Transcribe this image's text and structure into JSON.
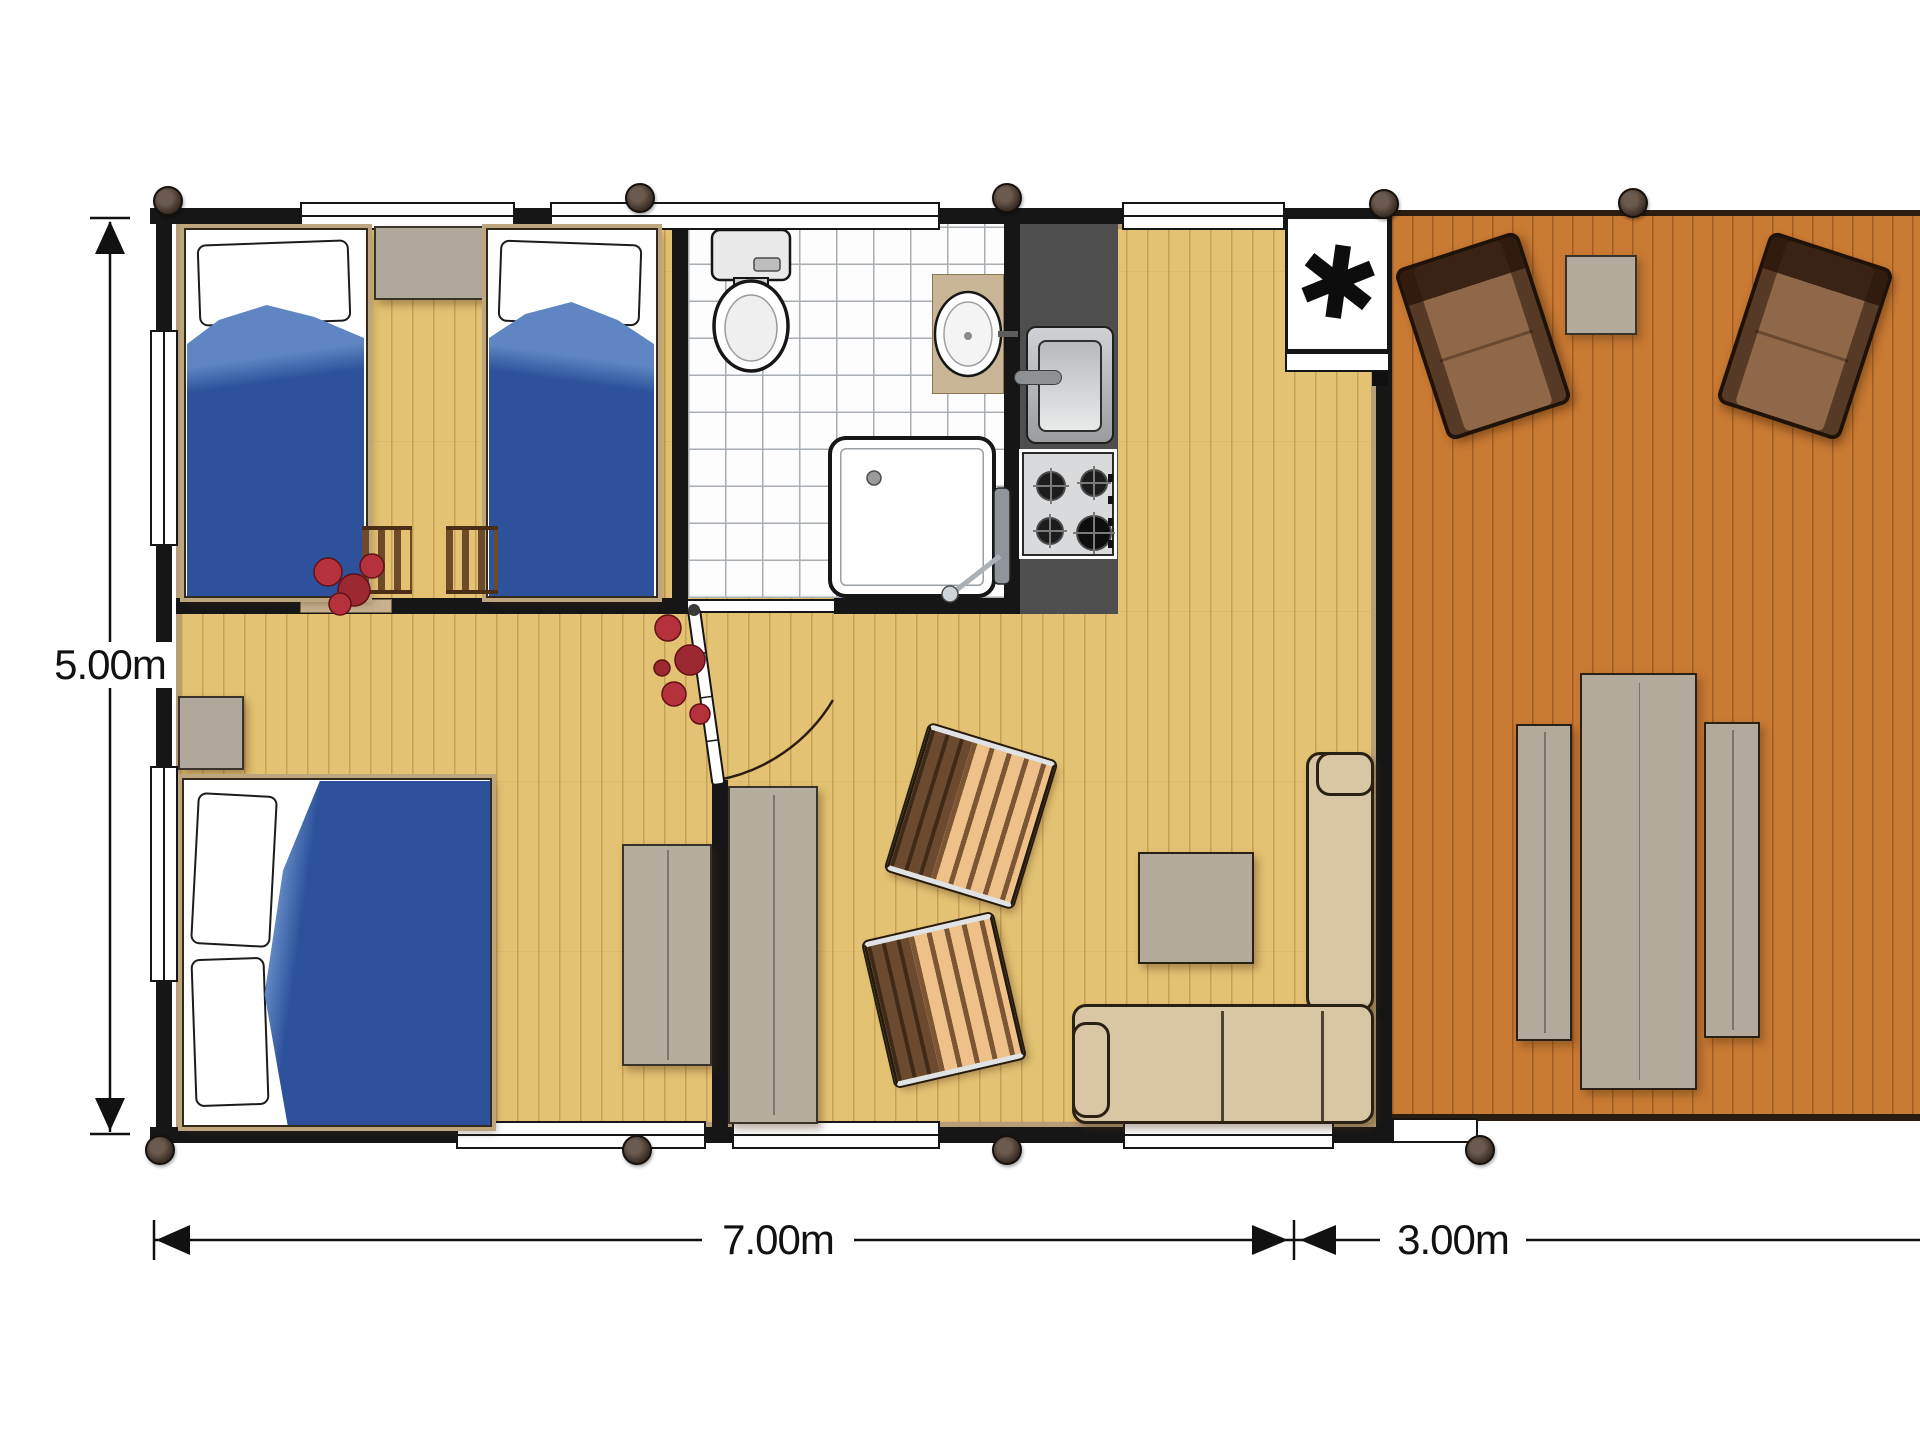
{
  "plan": {
    "type": "lodge-floor-plan",
    "dimension_labels": {
      "height": "5.00m",
      "main_width": "7.00m",
      "deck_width": "3.00m"
    },
    "boiler_symbol": "✱",
    "rooms": [
      {
        "name": "twin-bedroom",
        "contents": [
          "single-bed",
          "single-bed",
          "nightstand",
          "ladder-chair",
          "ladder-chair",
          "plant"
        ]
      },
      {
        "name": "bathroom",
        "contents": [
          "toilet",
          "washbasin",
          "shower-tray"
        ]
      },
      {
        "name": "kitchen",
        "contents": [
          "stainless-sink",
          "gas-hob-4-burners",
          "counter"
        ]
      },
      {
        "name": "double-bedroom",
        "contents": [
          "double-bed",
          "nightstand",
          "cabinet",
          "plant"
        ]
      },
      {
        "name": "living-area",
        "contents": [
          "wardrobe",
          "slatted-chair",
          "slatted-chair",
          "coffee-table",
          "corner-sofa",
          "water-heater-closet"
        ]
      },
      {
        "name": "deck",
        "contents": [
          "lounge-chair",
          "lounge-chair",
          "side-table",
          "dining-table",
          "bench",
          "bench"
        ]
      }
    ],
    "colors": {
      "interior_floor": "#e4c273",
      "deck_floor": "#c97a33",
      "walls": "#161616",
      "wall_lining": "#b79d78",
      "duvet_blue": "#2d529b",
      "duvet_fold_blue": "#5f86c2",
      "sofa_beige": "#d9c6a4",
      "gray_furniture": "#b0a89a",
      "kitchen_counter": "#4e4e4e",
      "chair_slat_tan": "#eec08a",
      "lounge_brown": "#8f6749",
      "plant_red": "#b5323d"
    }
  }
}
